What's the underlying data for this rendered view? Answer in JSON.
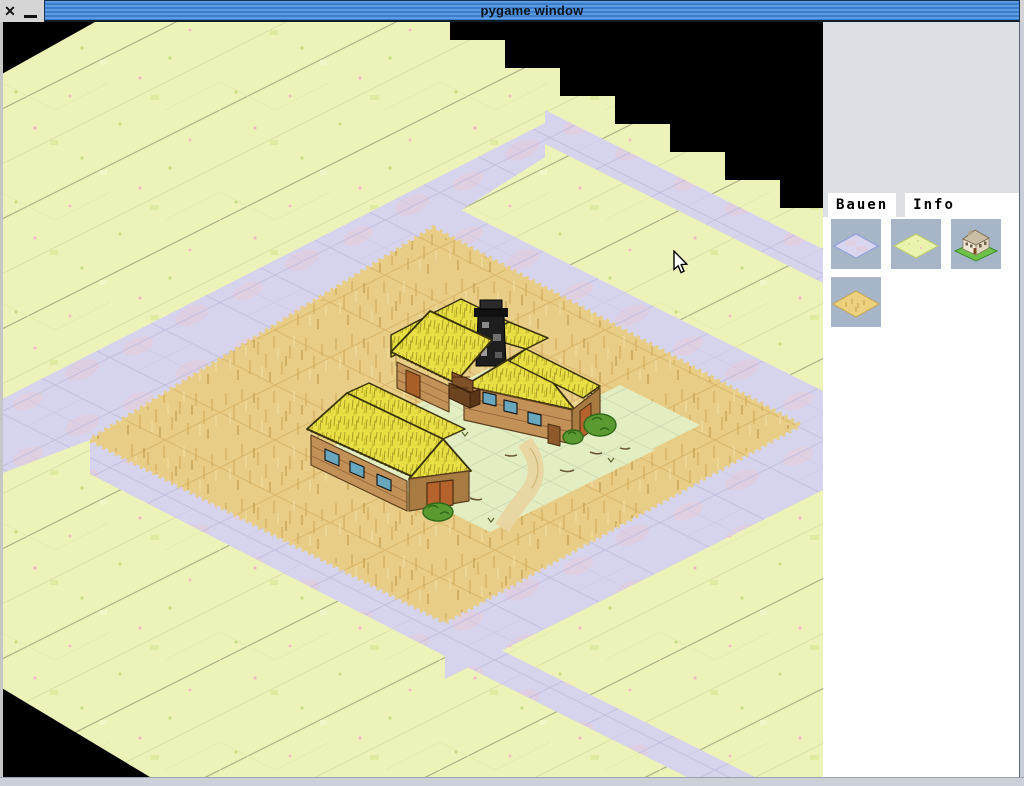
{
  "window": {
    "title": "pygame window",
    "close_label": "✕"
  },
  "panel": {
    "tabs": [
      {
        "label": "Bauen",
        "active": true
      },
      {
        "label": "Info",
        "active": false
      }
    ],
    "palette": [
      {
        "icon": "road-tile-icon"
      },
      {
        "icon": "grass-tile-icon"
      },
      {
        "icon": "house-icon"
      },
      {
        "icon": "field-tile-icon"
      }
    ]
  },
  "map": {
    "terrain_types": [
      "grass",
      "road",
      "wheat-field"
    ],
    "building": "thatched farmhouse with barn",
    "colors": {
      "grass": "#edf3b8",
      "road": "#d6d3ec",
      "field": "#e8cd86",
      "thatch": "#e8df45",
      "wood": "#c29158",
      "window_glass": "#68a7bd",
      "door": "#b5622d",
      "background": "#000000",
      "titlebar_blue": "#3b7dc8",
      "panel_gray": "#dcdfe3",
      "button_gray_blue": "#a7b5c9"
    }
  },
  "cursor": {
    "x": 672,
    "y": 250
  }
}
